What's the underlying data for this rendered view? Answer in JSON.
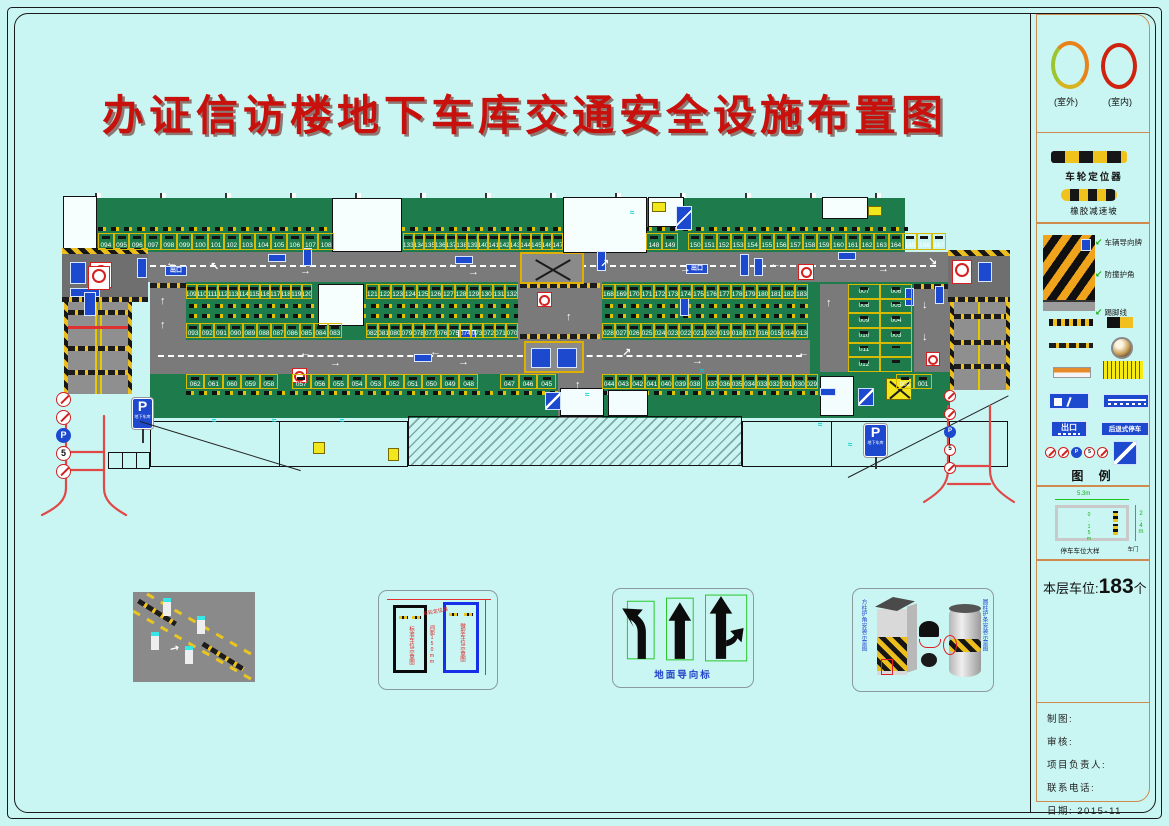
{
  "title": "办证信访楼地下车库交通安全设施布置图",
  "plan": {
    "p_sign": {
      "letter": "P",
      "text": "地下车库"
    },
    "exit_label": "出口",
    "stall_groups": [
      {
        "x": 98,
        "y": 233,
        "w": 236,
        "h": 17,
        "nums": [
          "094",
          "095",
          "096",
          "097",
          "098",
          "099",
          "100",
          "101",
          "102",
          "103",
          "104",
          "105",
          "106",
          "107",
          "108"
        ]
      },
      {
        "x": 403,
        "y": 233,
        "w": 160,
        "h": 17,
        "nums": [
          "133",
          "134",
          "135",
          "136",
          "137",
          "138",
          "139",
          "140",
          "141",
          "142",
          "143",
          "144",
          "145",
          "146",
          "147"
        ]
      },
      {
        "x": 646,
        "y": 233,
        "w": 32,
        "h": 17,
        "nums": [
          "148",
          "149"
        ]
      },
      {
        "x": 688,
        "y": 233,
        "w": 258,
        "h": 17,
        "nums": [
          "150",
          "151",
          "152",
          "153",
          "154",
          "155",
          "156",
          "157",
          "158",
          "159",
          "160",
          "161",
          "162",
          "163",
          "164",
          "165",
          "166",
          "167"
        ]
      },
      {
        "x": 186,
        "y": 284,
        "w": 126,
        "h": 15,
        "nums": [
          "109",
          "110",
          "111",
          "112",
          "113",
          "114",
          "115",
          "116",
          "117",
          "118",
          "119",
          "120"
        ]
      },
      {
        "x": 366,
        "y": 284,
        "w": 152,
        "h": 15,
        "nums": [
          "121",
          "122",
          "123",
          "124",
          "125",
          "126",
          "127",
          "128",
          "129",
          "130",
          "131",
          "132"
        ]
      },
      {
        "x": 602,
        "y": 284,
        "w": 206,
        "h": 15,
        "nums": [
          "168",
          "169",
          "170",
          "171",
          "172",
          "173",
          "174",
          "175",
          "176",
          "177",
          "178",
          "179",
          "180",
          "181",
          "182",
          "183"
        ]
      },
      {
        "x": 186,
        "y": 323,
        "w": 156,
        "h": 15,
        "nums": [
          "093",
          "092",
          "091",
          "090",
          "089",
          "088",
          "087",
          "086",
          "085",
          "084",
          "083"
        ]
      },
      {
        "x": 366,
        "y": 323,
        "w": 152,
        "h": 15,
        "nums": [
          "082",
          "081",
          "080",
          "079",
          "078",
          "077",
          "076",
          "075",
          "074",
          "073",
          "072",
          "071",
          "070"
        ]
      },
      {
        "x": 602,
        "y": 323,
        "w": 206,
        "h": 15,
        "nums": [
          "028",
          "027",
          "026",
          "025",
          "024",
          "023",
          "022",
          "021",
          "020",
          "019",
          "018",
          "017",
          "016",
          "015",
          "014",
          "013"
        ]
      },
      {
        "x": 186,
        "y": 374,
        "w": 92,
        "h": 15,
        "nums": [
          "062",
          "061",
          "060",
          "059",
          "058"
        ]
      },
      {
        "x": 292,
        "y": 374,
        "w": 186,
        "h": 15,
        "nums": [
          "057",
          "056",
          "055",
          "054",
          "053",
          "052",
          "051",
          "050",
          "049",
          "048"
        ]
      },
      {
        "x": 500,
        "y": 374,
        "w": 56,
        "h": 15,
        "nums": [
          "047",
          "046",
          "045"
        ]
      },
      {
        "x": 602,
        "y": 374,
        "w": 100,
        "h": 15,
        "nums": [
          "044",
          "043",
          "042",
          "041",
          "040",
          "039",
          "038"
        ]
      },
      {
        "x": 706,
        "y": 374,
        "w": 112,
        "h": 15,
        "nums": [
          "037",
          "036",
          "035",
          "034",
          "033",
          "032",
          "031",
          "030",
          "029"
        ]
      },
      {
        "x": 896,
        "y": 374,
        "w": 36,
        "h": 15,
        "nums": [
          "002",
          "001"
        ]
      }
    ],
    "block": {
      "x": 848,
      "y": 284,
      "w": 64,
      "h": 88,
      "left": [
        "007",
        "008",
        "009",
        "010",
        "011",
        "012"
      ],
      "right": [
        "006",
        "005",
        "004",
        "003",
        "",
        ""
      ]
    },
    "arrows": [
      [
        "←",
        166,
        258
      ],
      [
        "↖",
        210,
        262
      ],
      [
        "→",
        300,
        266
      ],
      [
        "←",
        448,
        259
      ],
      [
        "→",
        468,
        267
      ],
      [
        "↗",
        600,
        259
      ],
      [
        "→",
        680,
        264
      ],
      [
        "←",
        770,
        259
      ],
      [
        "→",
        878,
        264
      ],
      [
        "↘",
        928,
        257
      ],
      [
        "←",
        300,
        348
      ],
      [
        "→",
        330,
        358
      ],
      [
        "←",
        430,
        347
      ],
      [
        "→",
        458,
        357
      ],
      [
        "↗",
        622,
        348
      ],
      [
        "→",
        692,
        356
      ],
      [
        "←",
        798,
        348
      ],
      [
        "↑",
        160,
        296
      ],
      [
        "↑",
        160,
        320
      ],
      [
        "↑",
        540,
        296
      ],
      [
        "↑",
        566,
        312
      ],
      [
        "↑",
        826,
        298
      ],
      [
        "↓",
        922,
        300
      ],
      [
        "↓",
        922,
        332
      ],
      [
        "↑",
        575,
        380
      ]
    ]
  },
  "sign_rows": [
    {
      "x": 56,
      "y": 392,
      "size": 15,
      "glyphs": [
        "/",
        "/",
        "P",
        "5",
        "/"
      ]
    },
    {
      "x": 944,
      "y": 390,
      "size": 12,
      "glyphs": [
        "/",
        "/",
        "P",
        "5",
        "/"
      ]
    },
    {
      "x": 1044,
      "y": 446,
      "size": 11,
      "glyphs": [
        "/",
        "/",
        "P",
        "5",
        "/"
      ]
    }
  ],
  "sidebar": {
    "rings": {
      "outdoor": "(室外)",
      "indoor": "(室内)"
    },
    "wheel_stop_label": "车轮定位器",
    "speed_bump_label": "橡胶减速坡",
    "column_annotations": [
      {
        "label": "车辆导向牌",
        "y": 236
      },
      {
        "label": "防撞护角",
        "y": 268
      },
      {
        "label": "踢脚线",
        "y": 306
      }
    ],
    "exit_sign": "出口",
    "reverse_sign": "后退式停车",
    "legend_title": "图    例",
    "stall_detail": {
      "w": "5.3m",
      "h": "2.4m",
      "line": "0.15m",
      "door": "车门",
      "caption": "停车车位大样"
    },
    "count": {
      "prefix": "本层车位:",
      "value": "183",
      "unit": "个"
    },
    "titleblock": [
      "制图:",
      "审核:",
      "项目负责人:",
      "联系电话:",
      "日期: 2015-11"
    ]
  },
  "details": {
    "stall_schematic": {
      "standard": "标准车位示意图",
      "mini": "微型车位示意图",
      "wheel": "车轮定位器",
      "gap": "间距150mm"
    },
    "ground_arrows": {
      "caption": "地面导向标"
    },
    "column_guard": {
      "left": "方柱护角安装示意图",
      "right": "圆柱护条安装示意图"
    }
  }
}
